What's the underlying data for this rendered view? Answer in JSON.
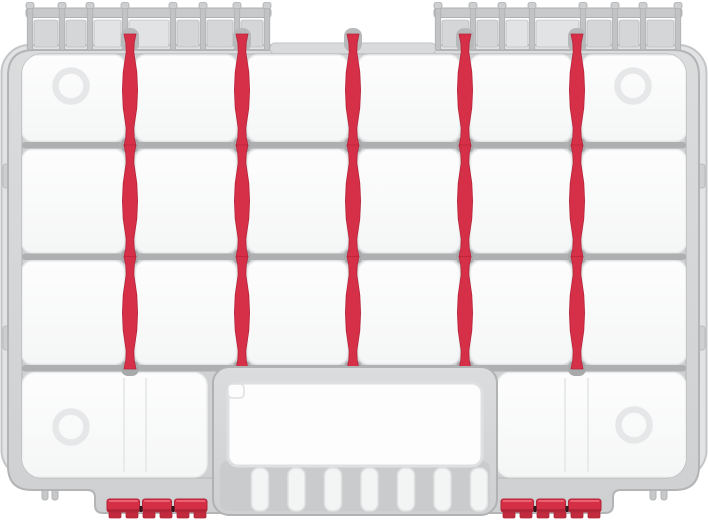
{
  "meta": {
    "description": "Gray plastic organizer case, top-down view, with white compartments, red adjustable dividers, hinge rails, red latches and ribbed carry handle",
    "canvas": {
      "w": 708,
      "h": 520
    }
  },
  "colors": {
    "background": "#ffffff",
    "shell_fill": "#e2e3e4",
    "shell_stroke": "#c3c5c7",
    "body_fill_top": "#dadcdd",
    "body_fill_bottom": "#ced0d2",
    "body_stroke": "#b2b4b6",
    "rim_lip": "#d8dadb",
    "rim_lip_stroke": "#c2c4c6",
    "hinge_bar": "#c7c9cb",
    "hinge_post": "#c1c3c5",
    "hinge_cap": "#cdcfd1",
    "hinge_panel": "#d4d6d8",
    "hinge_panel_light": "#e1e3e4",
    "hinge_stroke": "#aeb0b2",
    "interior_fill": "#cfd1d2",
    "interior_stroke": "#bec0c2",
    "rail_fill": "#adafb1",
    "socket_fill": "#a7a9ab",
    "top_socket_fill": "#b7b9bb",
    "cell_fill_top": "#fdfdfd",
    "cell_fill_bottom": "#f5f6f6",
    "cell_stroke": "#ebecec",
    "seam": "#e9eaeb",
    "dimple": "#e6e7e8",
    "divider_red": "#d62f48",
    "divider_red_dark": "#b5243a",
    "handle_stroke": "#b0b2b4",
    "grip_bg": "#c9cbcd",
    "slot_fill": "#f3f4f4",
    "slot_stroke": "#e0e1e2",
    "opening_fill": "#fdfdfd",
    "opening_stroke": "#dfe0e1",
    "latch_red": "#d52f46",
    "latch_red_top": "#ea5f72",
    "latch_red_dark": "#b22437",
    "latch_pin": "#33171c",
    "latch_foot": "#c22a3e",
    "foot_fill": "#c6c8ca",
    "foot_stroke": "#b3b5b7",
    "clip_fill": "#cdcfd1",
    "clip_stroke": "#bbbdbf"
  },
  "geometry": {
    "shell": {
      "x": 1.5,
      "y": 45,
      "w": 705,
      "h": 433,
      "rx": 28
    },
    "body": {
      "left": 8,
      "top": 50,
      "right": 699,
      "side_bottom": 490,
      "shelf_left": 95,
      "shelf_right": 613,
      "shelf_bottom": 513,
      "rx_top": 26,
      "rx_bottom": 24
    },
    "top_lip": {
      "x": 270,
      "y": 43,
      "w": 166,
      "h": 11,
      "rx": 5
    },
    "hinge": {
      "bar_y": 8,
      "bar_h": 9.5,
      "post_y": 5,
      "post_h": 45,
      "post_w": 5.5,
      "cap_y": 2.5,
      "cap_w": 8,
      "cap_h": 6,
      "panel_y": 20,
      "panel_h": 27,
      "groups": [
        {
          "posts": [
            30,
            62,
            90,
            125,
            173,
            203,
            237,
            267
          ],
          "light_panels": [
            2,
            3
          ]
        },
        {
          "posts": [
            438,
            473,
            502,
            532,
            583,
            615,
            643,
            678
          ],
          "light_panels": [
            2,
            3
          ]
        }
      ]
    },
    "interior": {
      "x": 22,
      "y": 54,
      "w": 664,
      "h": 424,
      "rx": 20
    },
    "rails": {
      "x": 22,
      "w": 664,
      "ys": [
        142,
        253.5,
        365
      ],
      "h": 6.5
    },
    "dividers": {
      "centers": [
        130,
        242,
        353,
        465,
        577
      ],
      "rows": [
        [
          34,
          146
        ],
        [
          145,
          257
        ],
        [
          256.5,
          369
        ]
      ],
      "profile": [
        [
          0,
          6
        ],
        [
          0.08,
          4.2
        ],
        [
          0.16,
          3.8
        ],
        [
          0.34,
          6.8
        ],
        [
          0.5,
          7.6
        ],
        [
          0.66,
          6.8
        ],
        [
          0.84,
          3.8
        ],
        [
          0.92,
          4.2
        ],
        [
          1,
          6
        ]
      ],
      "top_socket": {
        "y": 28,
        "w": 18,
        "h": 24,
        "rx": 8
      },
      "rail_socket": {
        "w": 18,
        "h": 15.5,
        "rx": 7,
        "dy": -4.5
      }
    },
    "cells": {
      "x_left": 22,
      "x_right": 686,
      "gap_half": 5.5,
      "rx": 10,
      "rows": [
        [
          55,
          141
        ],
        [
          149.5,
          252.5
        ],
        [
          261,
          364
        ]
      ],
      "bottom_row": {
        "y0": 372.5,
        "y1": 477,
        "left": [
          22,
          207
        ],
        "right": [
          497,
          686
        ]
      }
    },
    "seams": {
      "y0": 378,
      "y1": 472,
      "xs": [
        124,
        146,
        565,
        588
      ]
    },
    "dimples": {
      "r": 15.5,
      "stroke_w": 6.5,
      "centers": [
        [
          71,
          86
        ],
        [
          633,
          86
        ],
        [
          71,
          427
        ],
        [
          634,
          425
        ]
      ]
    },
    "handle": {
      "block": {
        "x": 213,
        "y": 367,
        "w": 284,
        "h": 148,
        "rx": 16
      },
      "grip_bg": {
        "x": 220,
        "y": 461,
        "w": 270,
        "h": 50,
        "rx": 8
      },
      "opening": {
        "x": 228,
        "y": 383,
        "w": 254,
        "h": 83,
        "rx": 10
      },
      "tab": {
        "x": 228,
        "y": 384,
        "w": 16,
        "h": 14,
        "rx": 4
      },
      "slots": {
        "count": 7,
        "x0": 251.5,
        "pitch": 36.5,
        "w": 17,
        "y": 468,
        "h": 43,
        "rx": 7.5
      }
    },
    "latches": {
      "y": 499,
      "h": 13,
      "x0s": [
        107,
        501
      ],
      "width": 100,
      "segments": [
        [
          0,
          32.5
        ],
        [
          35.5,
          64.5
        ],
        [
          67.5,
          100
        ]
      ],
      "pins": [
        32.5,
        64.5
      ],
      "pin_w": 3,
      "pin_y": 506,
      "pin_h": 6,
      "feet_offsets": [
        2,
        19,
        36,
        53,
        70,
        87
      ],
      "foot_w": 12,
      "foot_y": 512,
      "foot_h": 6
    },
    "gray_feet": {
      "pairs": [
        [
          42,
          52
        ],
        [
          650,
          661
        ]
      ],
      "w": 6,
      "y": 486,
      "h": 14,
      "rx": 2.5
    },
    "side_clips": {
      "ys": [
        164,
        326
      ],
      "h": 24,
      "w": 10,
      "left_x": 3,
      "right_x": 695,
      "rx": 3
    }
  }
}
